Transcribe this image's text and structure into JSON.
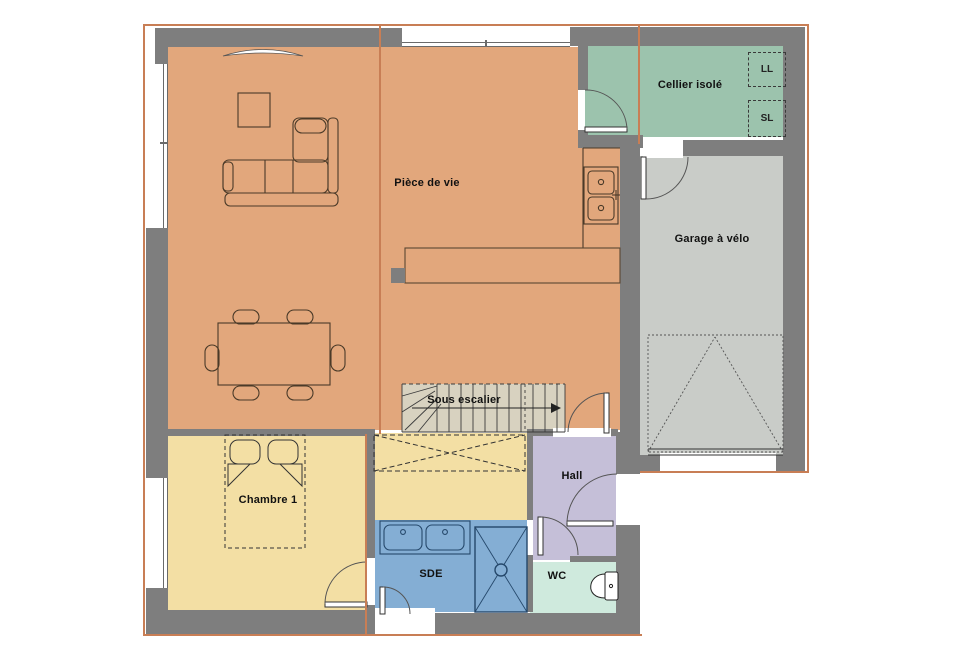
{
  "plan": {
    "type": "house-floor-plan",
    "rooms": {
      "living": {
        "label": "Pièce de vie",
        "color": "#e2a77c"
      },
      "cellier": {
        "label": "Cellier isolé",
        "color": "#9cc3ad"
      },
      "garage": {
        "label": "Garage à vélo",
        "color": "#c9ccc8"
      },
      "stairs": {
        "label": "Sous escalier",
        "color": "#d8d2c0"
      },
      "bedroom": {
        "label": "Chambre 1",
        "color": "#f3dfa4"
      },
      "closet": {
        "color": "#f3dfa4"
      },
      "hall": {
        "label": "Hall",
        "color": "#c5bfd8"
      },
      "shower_room": {
        "label": "SDE",
        "color": "#84aed4"
      },
      "wc": {
        "label": "WC",
        "color": "#cfeadd"
      }
    },
    "appliances": {
      "washing_machine": "LL",
      "dryer": "SL"
    },
    "colors": {
      "wall": "#7e7e7e",
      "boundary": "#c87e55",
      "furniture_stroke": "#4a3a28",
      "fixture_stroke": "#25486b"
    }
  }
}
